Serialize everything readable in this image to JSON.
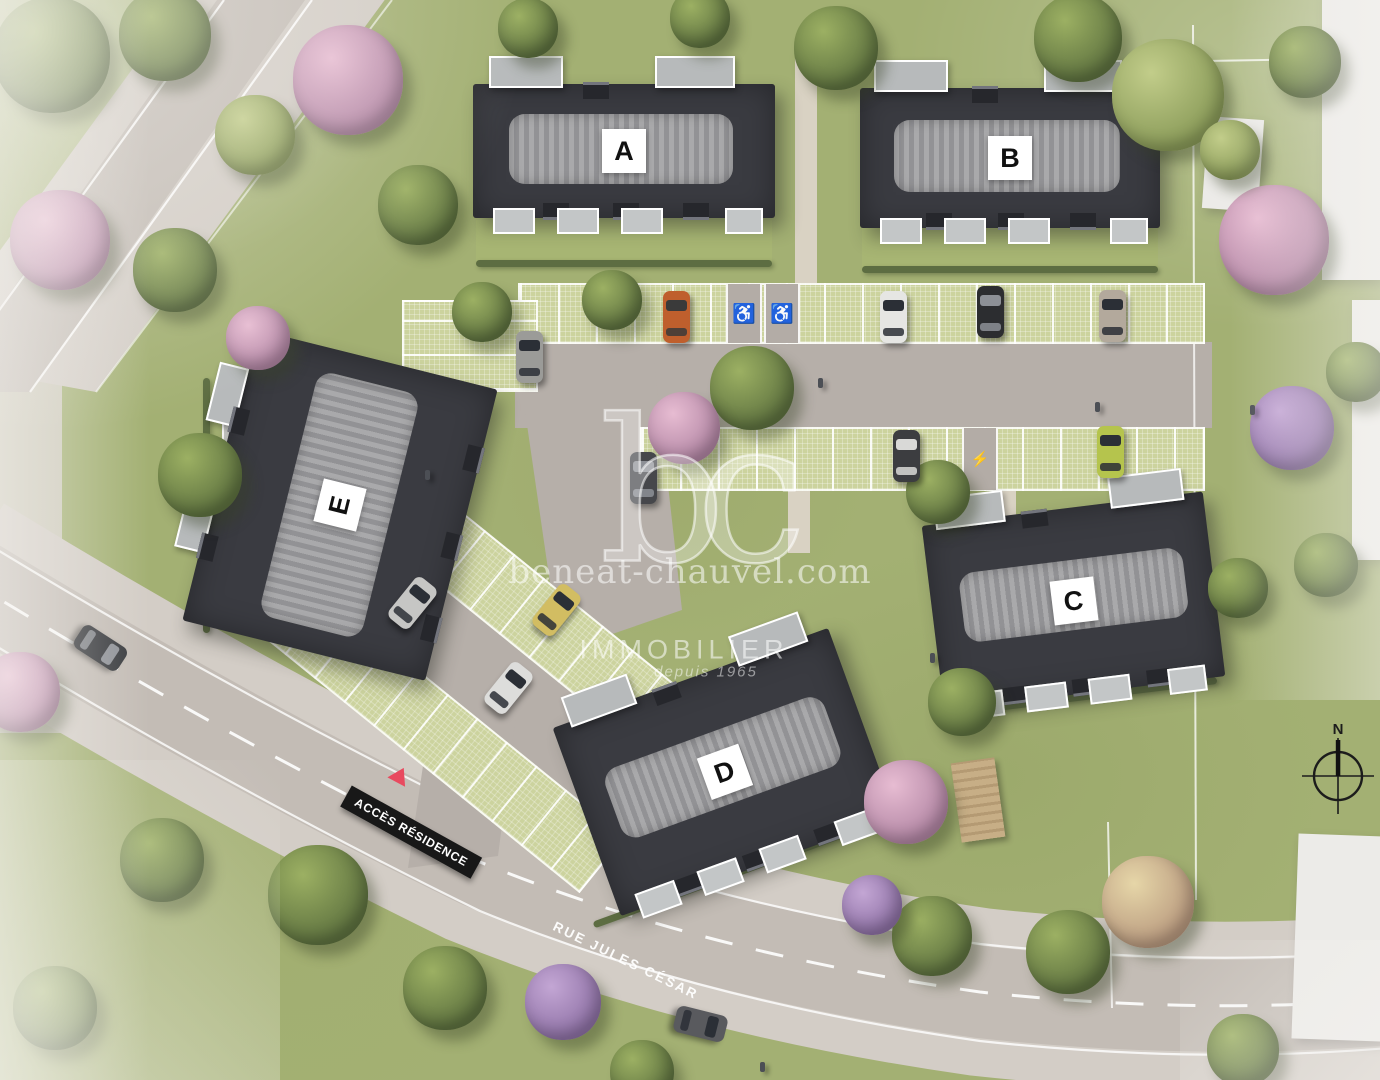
{
  "buildings": [
    {
      "id": "A",
      "label": "A"
    },
    {
      "id": "B",
      "label": "B"
    },
    {
      "id": "C",
      "label": "C"
    },
    {
      "id": "D",
      "label": "D"
    },
    {
      "id": "E",
      "label": "E"
    }
  ],
  "street": {
    "name": "RUE JULES CÉSAR"
  },
  "signs": {
    "residence_access": "ACCÈS RÉSIDENCE"
  },
  "compass": {
    "north": "N"
  },
  "watermark": {
    "monogram": "bc",
    "website": "beneat-chauvel.com",
    "brand": "IMMOBILIER",
    "tagline": "depuis 1965"
  },
  "icons": {
    "disabled_parking": "♿",
    "ev_charging": "⚡"
  },
  "colors": {
    "lawn": "#a3b073",
    "road": "#c3bcb5",
    "sidewalk": "#d3cdc6",
    "internal_asphalt": "#b6afa9",
    "pavers": "#ccd39e",
    "roof": "#3a3b41",
    "roof_band": "#a0a0a3",
    "label_background": "#ffffff",
    "label_text": "#111111",
    "sign_background": "#181818",
    "sign_text": "#ffffff",
    "access_triangle": "#e84a5f"
  }
}
